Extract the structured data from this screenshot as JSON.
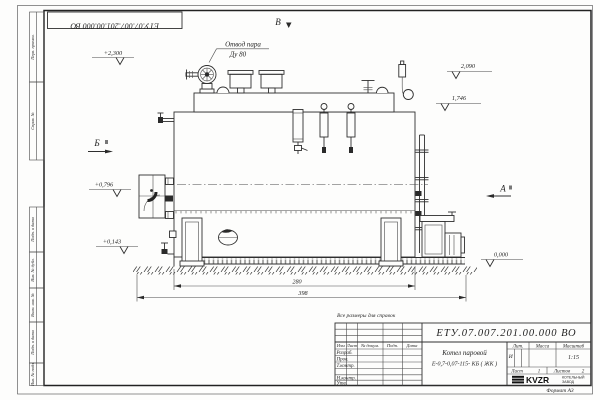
{
  "sheet": {
    "doc_number": "ЕТУ.07.007.201.00.000 ВО",
    "note": "Все размеры для справок",
    "format": "Формат А3"
  },
  "margin_stamps": {
    "perv_primen": "Перв. примен.",
    "sprav_no": "Справ. №",
    "podp_i_data_1": "Подп. и дата",
    "inv_no_dubl": "Инв. № дубл.",
    "vzam_inv_no": "Взам. инв. №",
    "podp_i_data_2": "Подп. и дата",
    "inv_no_podl": "Инв. № подл."
  },
  "title_block": {
    "doc_number": "ЕТУ.07.007.201.00.000 ВО",
    "product_title": "Котел паровой",
    "product_model": "Е-0,7-0,07-115- КБ ( ЖК )",
    "columns": {
      "izm": "Изм",
      "list": "Лист",
      "doc": "№ докум.",
      "podp": "Подп.",
      "data": "Дата"
    },
    "rows": {
      "razrab": "Разраб.",
      "prov": "Пров.",
      "t_kontr": "Т.контр.",
      "n_kontr": "Н.контр.",
      "utv": "Утв."
    },
    "lit_header": "Лит.",
    "mass_header": "Масса",
    "scale_header": "Масштаб",
    "lit_value": "И",
    "scale_value": "1:15",
    "sheet_label": "Лист",
    "sheet_number": "1",
    "sheets_label": "Листов",
    "sheets_total": "2",
    "logo_text": "KVZR",
    "logo_caption_line1": "КОТЕЛЬНЫЙ",
    "logo_caption_line2": "ЗАВОД"
  },
  "drawing": {
    "callout": {
      "line1": "Отвод пара",
      "line2": "Ду 80"
    },
    "views": {
      "top": "В",
      "left": "Б",
      "right": "А"
    },
    "elevations": {
      "platform": "+2,300",
      "valve_top": "2,090",
      "drum_top": "1,746",
      "burner_axis": "+0,796",
      "low": "+0,143",
      "ground": "0,000"
    },
    "dimensions": {
      "boiler_length": "280",
      "overall_length": "398"
    }
  }
}
